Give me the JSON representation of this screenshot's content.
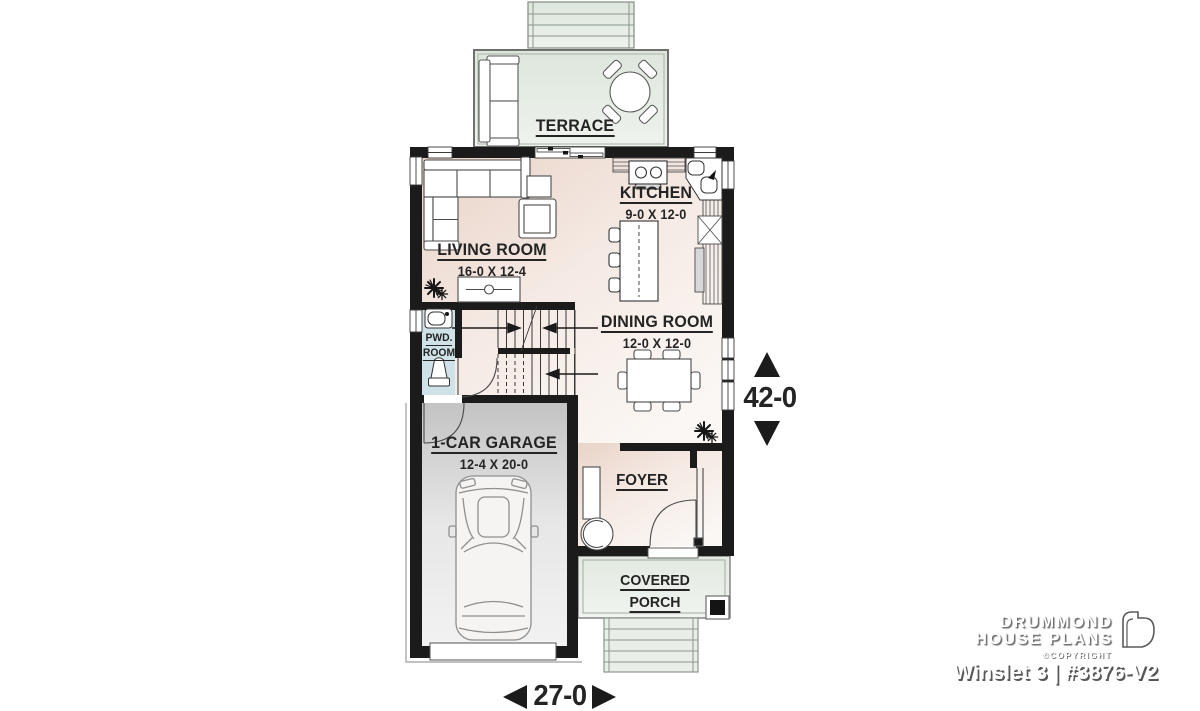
{
  "rooms": {
    "terrace": {
      "label": "TERRACE"
    },
    "living_room": {
      "label": "LIVING ROOM",
      "size": "16-0 X 12-4"
    },
    "kitchen": {
      "label": "KITCHEN",
      "size": "9-0 X 12-0"
    },
    "dining_room": {
      "label": "DINING ROOM",
      "size": "12-0 X 12-0"
    },
    "powder_room": {
      "label_line1": "PWD.",
      "label_line2": "ROOM"
    },
    "garage": {
      "label": "1-CAR GARAGE",
      "size": "12-4 X 20-0"
    },
    "foyer": {
      "label": "FOYER"
    },
    "covered_porch": {
      "label_line1": "COVERED",
      "label_line2": "PORCH"
    }
  },
  "dimensions": {
    "depth": "42-0",
    "width": "27-0"
  },
  "branding": {
    "brand_line1": "DRUMMOND",
    "brand_line2": "HOUSE PLANS",
    "copyright_label": "©COPYRIGHT",
    "plan_title": "Winslet 3 | #3876-V2"
  },
  "icons": {
    "plant": "starburst-plant-icon",
    "dimension_arrows": "solid-triangle-arrows",
    "brand_mark": "open-door-outline-icon"
  },
  "colors": {
    "walls": "#1b1b1b",
    "interior_floor": "#f2e4da",
    "outdoor_floor": "#e4ebe2",
    "garage_floor": "#d9d9d9",
    "powder_room_floor": "#cfe2e8",
    "label_text": "#242424",
    "brand_text": "#ffffff"
  }
}
